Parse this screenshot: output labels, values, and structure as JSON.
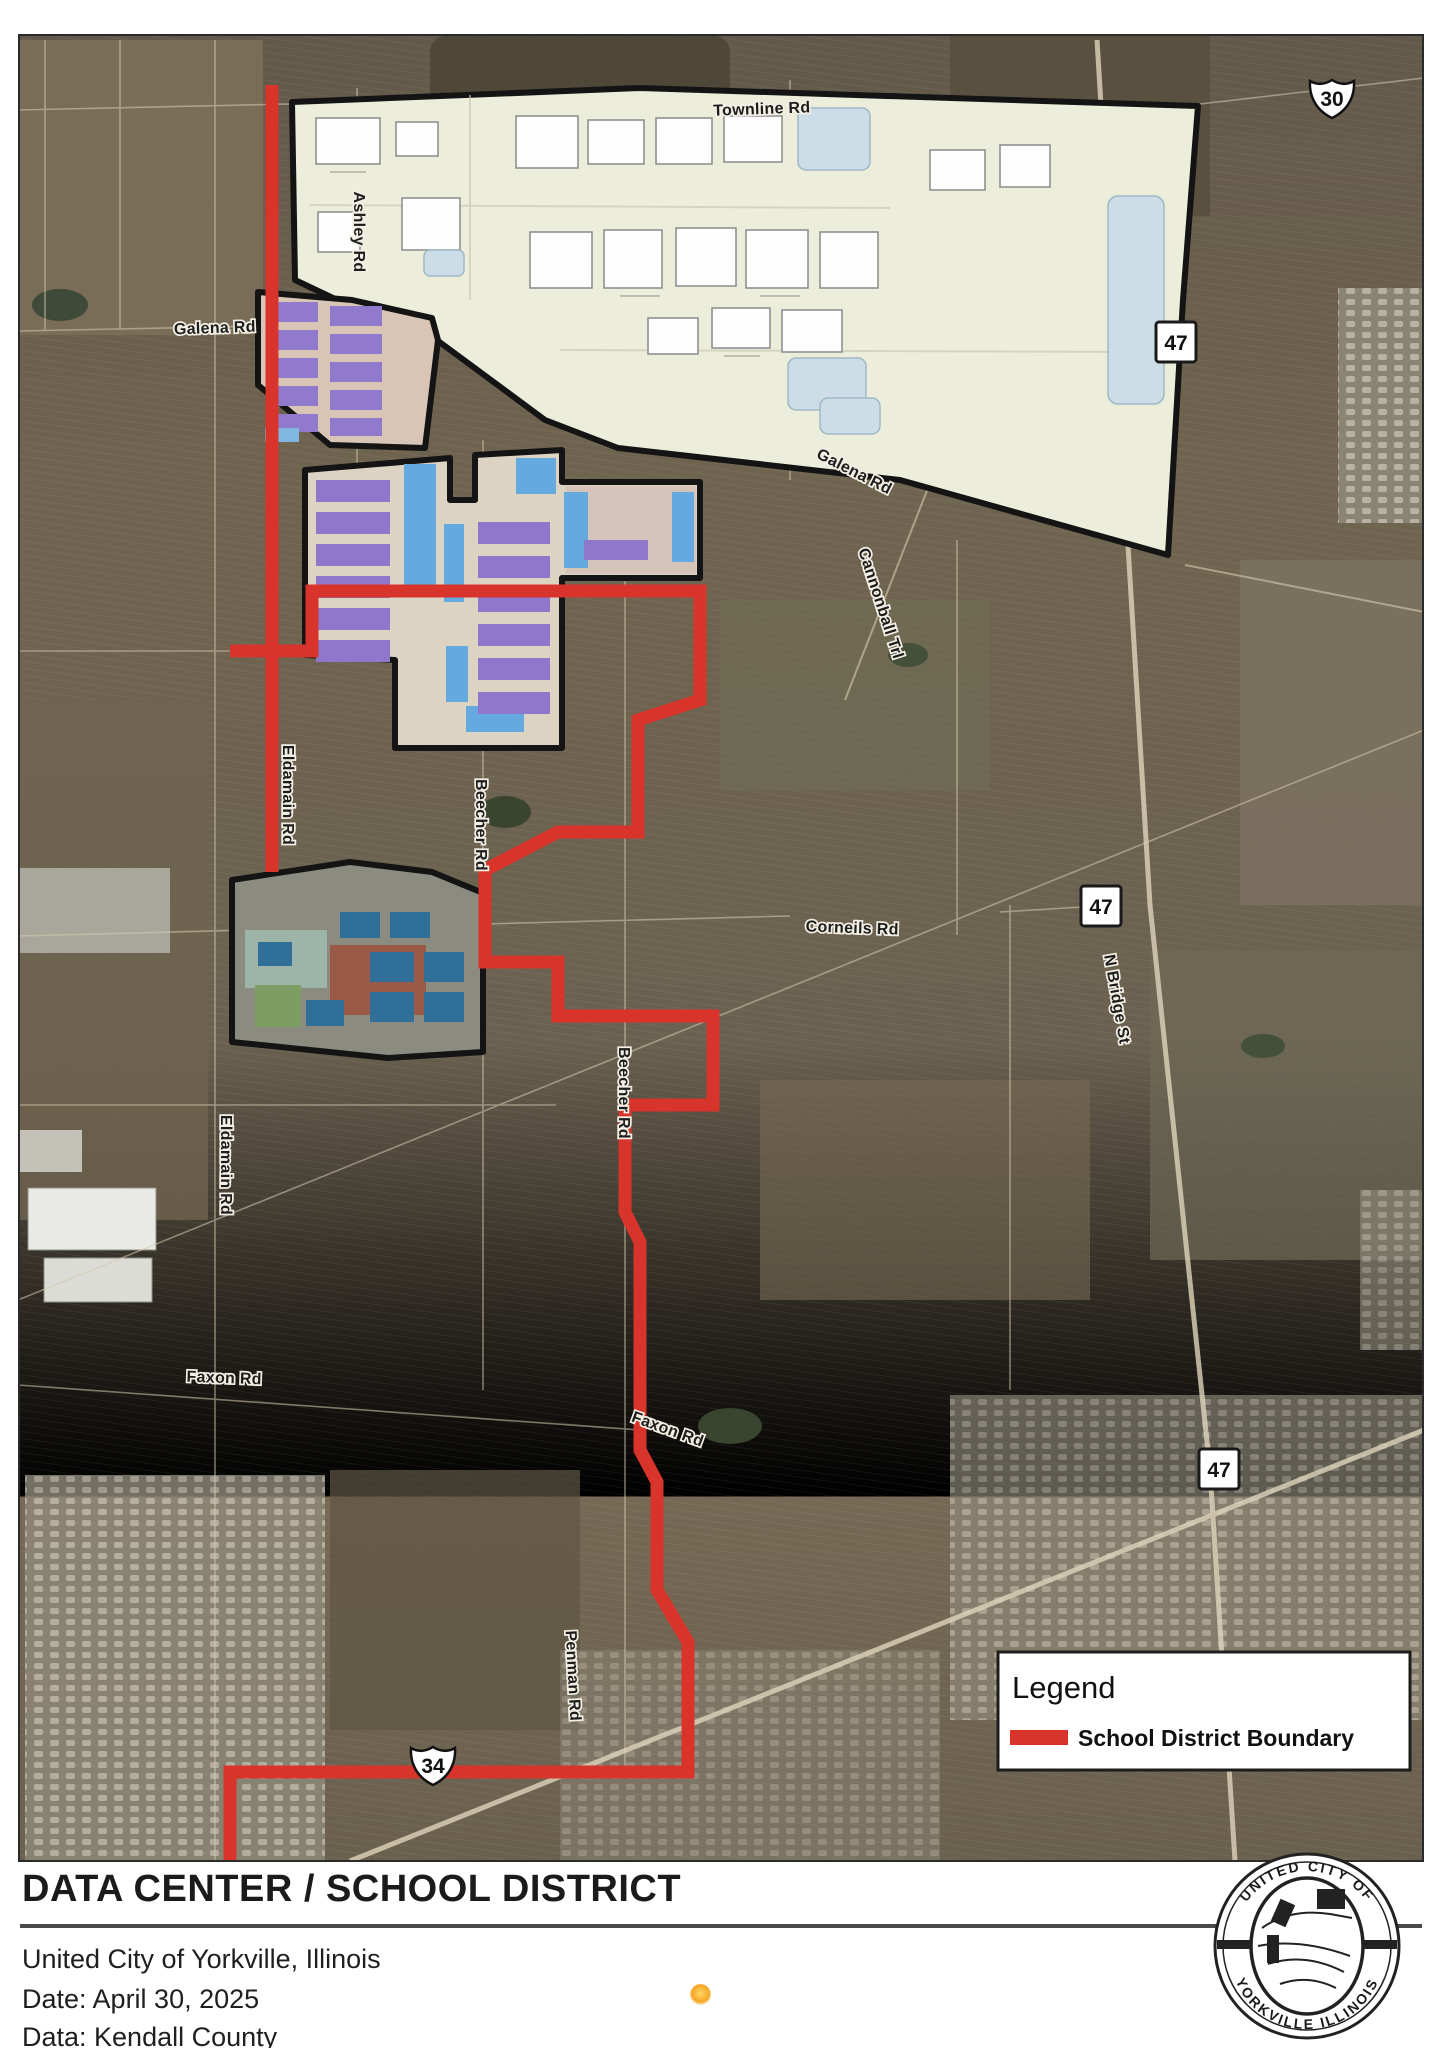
{
  "map": {
    "legend": {
      "title": "Legend",
      "items": [
        {
          "label": "School District Boundary",
          "color": "#d9342b"
        }
      ]
    },
    "boundary_color": "#d9342b",
    "shields": [
      {
        "system": "US",
        "number": "30"
      },
      {
        "system": "IL",
        "number": "47"
      },
      {
        "system": "IL",
        "number": "47"
      },
      {
        "system": "IL",
        "number": "47"
      },
      {
        "system": "US",
        "number": "34"
      }
    ],
    "road_labels": [
      "Townline Rd",
      "Ashley Rd",
      "Galena Rd",
      "Galena Rd",
      "Eldamain Rd",
      "Eldamain Rd",
      "Corneils Rd",
      "Beecher Rd",
      "Beecher Rd",
      "N Bridge St",
      "Cannonball Trl",
      "Faxon Rd",
      "Faxon Rd",
      "Penman Rd"
    ]
  },
  "footer": {
    "title": "DATA CENTER / SCHOOL DISTRICT",
    "location": "United City of Yorkville, Illinois",
    "date_line": "Date: April 30, 2025",
    "data_line": "Data: Kendall County"
  },
  "seal": {
    "top_text": "UNITED CITY OF",
    "bottom_text": "YORKVILLE   ILLINOIS"
  }
}
